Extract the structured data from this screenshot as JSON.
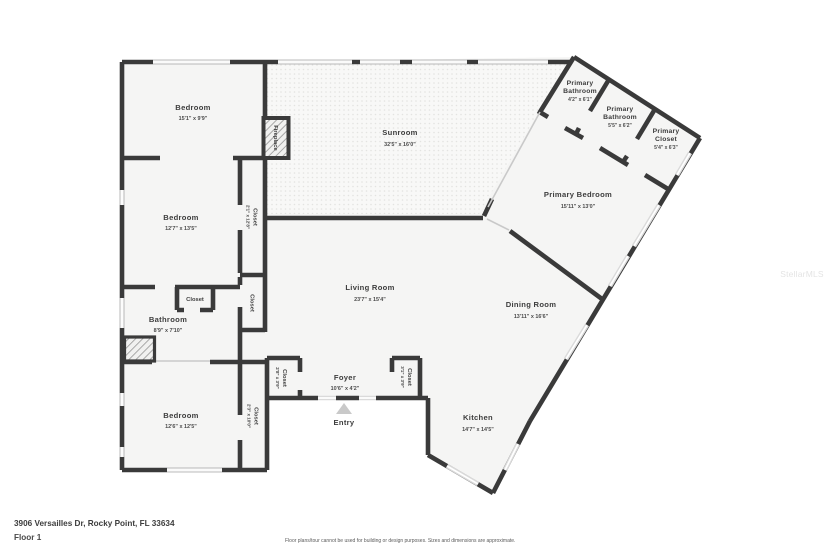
{
  "meta": {
    "address": "3906 Versailles Dr, Rocky Point, FL 33634",
    "floor_label": "Floor 1",
    "disclaimer": "Floor plans/tour cannot be used for building or design purposes. Sizes and dimensions are approximate.",
    "watermark": "StellarMLS"
  },
  "colors": {
    "wall": "#3a3a3a",
    "room_fill": "#f5f5f4",
    "window": "#dadada",
    "label": "#3d3d3d",
    "dims": "#4b4b4b",
    "watermark": "#e4e4e4"
  },
  "rooms": {
    "bedroom1": {
      "name": "Bedroom",
      "dims": "15'1\" x 9'9\""
    },
    "bedroom2": {
      "name": "Bedroom",
      "dims": "12'7\" x 13'5\""
    },
    "bedroom3": {
      "name": "Bedroom",
      "dims": "12'6\" x 12'5\""
    },
    "bathroom": {
      "name": "Bathroom",
      "dims": "8'9\" x 7'10\""
    },
    "sunroom": {
      "name": "Sunroom",
      "dims": "32'5\" x 16'0\""
    },
    "living": {
      "name": "Living Room",
      "dims": "23'7\" x 15'4\""
    },
    "dining": {
      "name": "Dining Room",
      "dims": "13'11\" x 16'6\""
    },
    "kitchen": {
      "name": "Kitchen",
      "dims": "14'7\" x 14'5\""
    },
    "foyer": {
      "name": "Foyer",
      "dims": "10'6\" x 4'2\""
    },
    "entry": {
      "name": "Entry"
    },
    "primary_bedroom": {
      "name": "Primary Bedroom",
      "dims": "15'11\" x 13'0\""
    },
    "primary_bath1": {
      "line1": "Primary",
      "line2": "Bathroom",
      "dims": "4'2\" x 6'1\""
    },
    "primary_bath2": {
      "line1": "Primary",
      "line2": "Bathroom",
      "dims": "5'5\" x 6'2\""
    },
    "primary_closet": {
      "line1": "Primary",
      "line2": "Closet",
      "dims": "5'4\" x 6'3\""
    },
    "fireplace": {
      "name": "Fireplace"
    },
    "closet_hall": {
      "name": "Closet",
      "dims": "2'1\" x 12'8\""
    },
    "closet_hall2": {
      "name": "Closet"
    },
    "closet_bath": {
      "name": "Closet"
    },
    "closet_bed3": {
      "name": "Closet",
      "dims": "2'3\" x 10'0\""
    },
    "closet_foyer_left": {
      "name": "Closet",
      "dims": "2'8\" x 3'9\""
    },
    "closet_foyer_right": {
      "name": "Closet",
      "dims": "3'1\" x 3'9\""
    }
  }
}
